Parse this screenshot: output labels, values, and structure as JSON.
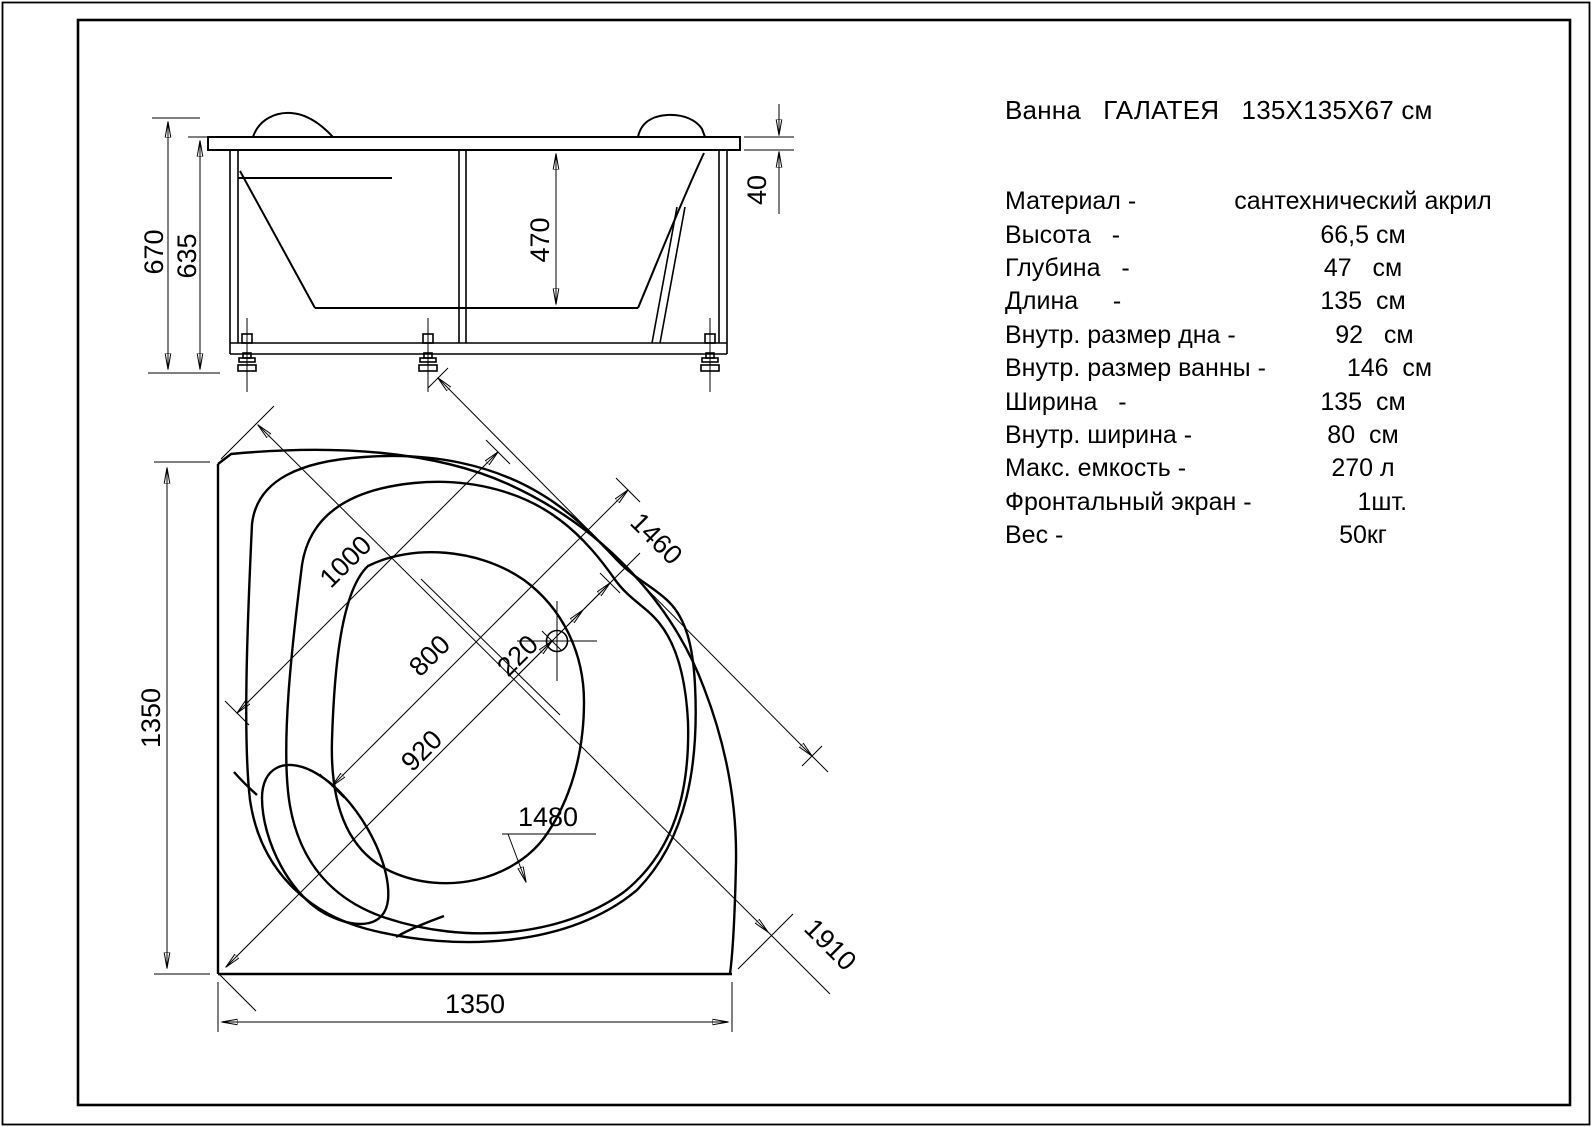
{
  "title": "Ванна   ГАЛАТЕЯ   135X135X67 см",
  "specs": [
    {
      "label": "Материал -",
      "value": "сантехнический акрил"
    },
    {
      "label": "Высота   -",
      "value": "66,5 см"
    },
    {
      "label": "Глубина   -",
      "value": "47   см"
    },
    {
      "label": "Длина     -",
      "value": "135  см"
    },
    {
      "label": "Внутр. размер дна -",
      "value": "92   см"
    },
    {
      "label": "Внутр. размер ванны -",
      "value": "146  см"
    },
    {
      "label": "Ширина   -",
      "value": "135  см"
    },
    {
      "label": "Внутр. ширина -",
      "value": "80  см"
    },
    {
      "label": "Макс. емкость -",
      "value": "270 л"
    },
    {
      "label": "Фронтальный экран -",
      "value": "1шт."
    },
    {
      "label": "Вес -",
      "value": "50кг"
    }
  ],
  "dimensions": {
    "side_view": {
      "overall_height": "670",
      "frame_height": "635",
      "inner_depth": "470",
      "rim_thickness": "40"
    },
    "plan_view": {
      "side_vertical": "1350",
      "side_horizontal": "1350",
      "rim_opening": "1000",
      "inner_width": "800",
      "bottom_size": "920",
      "drain_offset": "220",
      "inner_length": "1460",
      "callout": "1480",
      "corner_diagonal": "1910"
    }
  },
  "colors": {
    "line": "#000000",
    "background": "#ffffff"
  }
}
